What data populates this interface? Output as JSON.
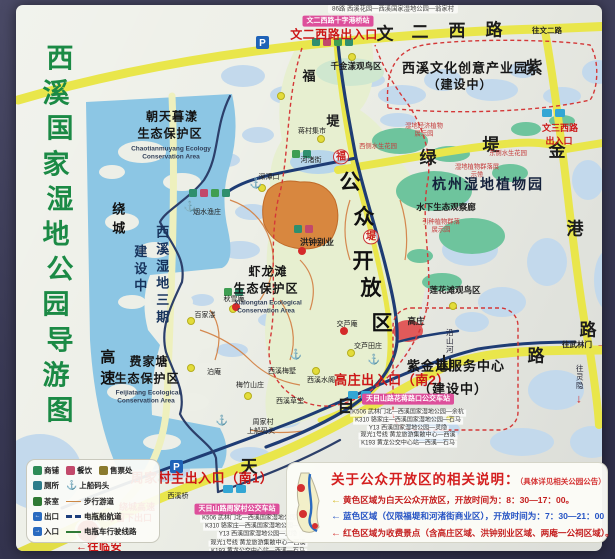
{
  "title": {
    "text": "西溪国家湿地公园导游图",
    "color": "#1b8a45"
  },
  "colors": {
    "road_yellow": "#e9e64b",
    "water_light": "#c3d9ec",
    "water_deep": "#8cc6e4",
    "open_area_green": "#e7efd0",
    "garden_teal": "#6ec49d",
    "canal_navy": "#1e3c74",
    "boundary_red_dash": "#d43838",
    "paid_area_orange": "#d8873f",
    "badge_pink": "#dd4f9b",
    "entrance_red": "#cc1616",
    "title_green": "#1b8a45"
  },
  "bus_lines": [
    "K506 武林门北—西溪国家湿地公园—余杭",
    "K310 骆家庄—西溪国家湿地公园—石马",
    "Y13 西溪国家湿地公园—灵隐",
    "观光1号线 黄龙旅游集散中心—西溪",
    "K193 黄龙公交中心站—西溪—石马"
  ],
  "bus_stations": [
    {
      "badge": "天目山路花蒋路口公交车站",
      "x": 408,
      "y": 399,
      "lx": 408,
      "y0": 413,
      "dy": 7.8
    },
    {
      "badge": "天目山路周家村公交车站",
      "x": 237,
      "y": 509,
      "lx": 258,
      "y0": 519,
      "dy": 8.2
    }
  ],
  "map_labels": [
    {
      "t": "86路 西溪花园—西溪国家湿地公园—翁家村",
      "x": 393,
      "y": 9,
      "c": "busTop"
    },
    {
      "t": "文二西路十字港桥站",
      "x": 338,
      "y": 21,
      "c": "badge"
    },
    {
      "t": "文二西路出入口",
      "x": 334,
      "y": 35,
      "c": "ent"
    },
    {
      "t": "文",
      "x": 385,
      "y": 34,
      "c": "rd"
    },
    {
      "t": "二",
      "x": 420,
      "y": 32,
      "c": "rd"
    },
    {
      "t": "西",
      "x": 457,
      "y": 31,
      "c": "rd"
    },
    {
      "t": "路",
      "x": 494,
      "y": 30,
      "c": "rd"
    },
    {
      "t": "往文二路",
      "x": 547,
      "y": 31,
      "c": "dir"
    },
    {
      "t": "千金漾观鸟区",
      "x": 356,
      "y": 67,
      "c": "poi"
    },
    {
      "t": "西溪文化创意产业园",
      "x": 465,
      "y": 69,
      "c": "area",
      "fs": 13
    },
    {
      "t": "（建设中）",
      "x": 460,
      "y": 85,
      "c": "area",
      "fs": 12
    },
    {
      "t": "紫",
      "x": 534,
      "y": 68,
      "c": "rd"
    },
    {
      "t": "金",
      "x": 557,
      "y": 151,
      "c": "rd"
    },
    {
      "t": "港",
      "x": 575,
      "y": 229,
      "c": "rd"
    },
    {
      "t": "路",
      "x": 588,
      "y": 330,
      "c": "rd"
    },
    {
      "t": "福",
      "x": 309,
      "y": 77,
      "c": "rd2"
    },
    {
      "t": "堤",
      "x": 333,
      "y": 122,
      "c": "rd2"
    },
    {
      "t": "蒋村集市",
      "x": 312,
      "y": 132,
      "c": "poiT"
    },
    {
      "t": "朝天暮漾",
      "x": 172,
      "y": 117,
      "c": "area"
    },
    {
      "t": "生态保护区",
      "x": 170,
      "y": 134,
      "c": "area"
    },
    {
      "t": "Chaotianmuyang Ecology",
      "x": 171,
      "y": 149,
      "c": "areaE"
    },
    {
      "t": "Conservation Area",
      "x": 171,
      "y": 157,
      "c": "areaE"
    },
    {
      "t": "湿地经济植物展示园",
      "x": 424,
      "y": 130,
      "c": "redT",
      "w": 40
    },
    {
      "t": "文三西路",
      "x": 560,
      "y": 128,
      "c": "entS"
    },
    {
      "t": "出入口",
      "x": 559,
      "y": 141,
      "c": "entS"
    },
    {
      "t": "绿",
      "x": 428,
      "y": 158,
      "c": "rd"
    },
    {
      "t": "堤",
      "x": 491,
      "y": 145,
      "c": "rd"
    },
    {
      "t": "西侧水生花园",
      "x": 378,
      "y": 147,
      "c": "redT"
    },
    {
      "t": "东侧水生花园",
      "x": 508,
      "y": 154,
      "c": "redT"
    },
    {
      "t": "湿地植物群落展示带",
      "x": 477,
      "y": 171,
      "c": "redT",
      "w": 48
    },
    {
      "t": "杭州湿地植物园",
      "x": 488,
      "y": 185,
      "c": "garden"
    },
    {
      "t": "水下生态观察廊",
      "x": 446,
      "y": 208,
      "c": "poi"
    },
    {
      "t": "引种植物群落展示园",
      "x": 441,
      "y": 226,
      "c": "redT",
      "w": 42
    },
    {
      "t": "河渚街",
      "x": 311,
      "y": 161,
      "c": "poiT"
    },
    {
      "t": "深潭口",
      "x": 269,
      "y": 178,
      "c": "poiT"
    },
    {
      "t": "烟水渔庄",
      "x": 207,
      "y": 213,
      "c": "poiT"
    },
    {
      "t": "洪钟别业",
      "x": 317,
      "y": 243,
      "c": "poi"
    },
    {
      "t": "公",
      "x": 350,
      "y": 183,
      "c": "big"
    },
    {
      "t": "众",
      "x": 364,
      "y": 218,
      "c": "big"
    },
    {
      "t": "开",
      "x": 363,
      "y": 262,
      "c": "big"
    },
    {
      "t": "放",
      "x": 371,
      "y": 289,
      "c": "big"
    },
    {
      "t": "区",
      "x": 382,
      "y": 324,
      "c": "big"
    },
    {
      "t": "福",
      "x": 341,
      "y": 157,
      "c": "circ"
    },
    {
      "t": "堤",
      "x": 371,
      "y": 237,
      "c": "circ"
    },
    {
      "t": "西溪湿地三期",
      "x": 161,
      "y": 276,
      "c": "vt"
    },
    {
      "t": "建设中",
      "x": 139,
      "y": 270,
      "c": "vt"
    },
    {
      "t": "绕城",
      "x": 117,
      "y": 221,
      "c": "vtB",
      "fs": 13
    },
    {
      "t": "高速",
      "x": 106,
      "y": 370,
      "c": "vtB"
    },
    {
      "t": "虾龙滩",
      "x": 268,
      "y": 272,
      "c": "area"
    },
    {
      "t": "生态保护区",
      "x": 266,
      "y": 289,
      "c": "area"
    },
    {
      "t": "Xialongtan Ecological",
      "x": 268,
      "y": 303,
      "c": "areaE"
    },
    {
      "t": "Conservation Area",
      "x": 266,
      "y": 311,
      "c": "areaE"
    },
    {
      "t": "秋雪庵",
      "x": 234,
      "y": 300,
      "c": "poiT"
    },
    {
      "t": "百家溇",
      "x": 205,
      "y": 316,
      "c": "poiT"
    },
    {
      "t": "费家塘",
      "x": 149,
      "y": 362,
      "c": "area"
    },
    {
      "t": "生态保护区",
      "x": 147,
      "y": 379,
      "c": "area"
    },
    {
      "t": "Feijiatang Ecological",
      "x": 148,
      "y": 393,
      "c": "areaE"
    },
    {
      "t": "Conservation Area",
      "x": 146,
      "y": 401,
      "c": "areaE"
    },
    {
      "t": "泊庵",
      "x": 214,
      "y": 373,
      "c": "poiT"
    },
    {
      "t": "梅竹山庄",
      "x": 250,
      "y": 386,
      "c": "poiT"
    },
    {
      "t": "西溪梅墅",
      "x": 282,
      "y": 372,
      "c": "poiT"
    },
    {
      "t": "西溪草堂",
      "x": 290,
      "y": 402,
      "c": "poiT"
    },
    {
      "t": "周家村",
      "x": 263,
      "y": 423,
      "c": "poiT"
    },
    {
      "t": "上船码头",
      "x": 261,
      "y": 432,
      "c": "poiT"
    },
    {
      "t": "交芦庵",
      "x": 347,
      "y": 325,
      "c": "poiT"
    },
    {
      "t": "交芦田庄",
      "x": 368,
      "y": 347,
      "c": "poiT"
    },
    {
      "t": "高庄",
      "x": 416,
      "y": 322,
      "c": "poi"
    },
    {
      "t": "西溪水阁",
      "x": 321,
      "y": 381,
      "c": "poiT"
    },
    {
      "t": "沿山河",
      "x": 449,
      "y": 341,
      "c": "vtT"
    },
    {
      "t": "天",
      "x": 249,
      "y": 467,
      "c": "rd"
    },
    {
      "t": "目",
      "x": 346,
      "y": 407,
      "c": "rd"
    },
    {
      "t": "山",
      "x": 444,
      "y": 364,
      "c": "rd"
    },
    {
      "t": "路",
      "x": 536,
      "y": 356,
      "c": "rd"
    },
    {
      "t": "高庄出入口（南2）",
      "x": 392,
      "y": 381,
      "c": "ent",
      "fs": 13
    },
    {
      "t": "莲花滩观鸟区",
      "x": 455,
      "y": 291,
      "c": "poi"
    },
    {
      "t": "紫金港服务中心",
      "x": 456,
      "y": 367,
      "c": "area",
      "fs": 13
    },
    {
      "t": "（建设中）",
      "x": 453,
      "y": 390,
      "c": "area",
      "fs": 13
    },
    {
      "t": "周家村主出入口（南1）",
      "x": 202,
      "y": 479,
      "c": "ent",
      "fs": 13
    },
    {
      "t": "西溪桥",
      "x": 178,
      "y": 497,
      "c": "poiT"
    },
    {
      "t": "往武林门",
      "x": 577,
      "y": 345,
      "c": "dir"
    },
    {
      "t": "→",
      "x": 602,
      "y": 344,
      "c": "redArrow"
    },
    {
      "t": "往灵隐",
      "x": 579,
      "y": 377,
      "c": "vtT"
    },
    {
      "t": "↓",
      "x": 579,
      "y": 399,
      "c": "redArrow"
    },
    {
      "t": "绕城高速",
      "x": 137,
      "y": 507,
      "c": "entS"
    },
    {
      "t": "留下出口",
      "x": 134,
      "y": 518,
      "c": "entS"
    },
    {
      "t": "↗",
      "x": 114,
      "y": 519,
      "c": "redArrow"
    },
    {
      "t": "←往临安",
      "x": 99,
      "y": 547,
      "c": "ent",
      "fs": 11
    },
    {
      "t": "⚓",
      "x": 190,
      "y": 207,
      "c": "anch"
    },
    {
      "t": "⚓",
      "x": 256,
      "y": 184,
      "c": "anch"
    },
    {
      "t": "⚓",
      "x": 222,
      "y": 421,
      "c": "anch"
    },
    {
      "t": "⚓",
      "x": 296,
      "y": 355,
      "c": "anch"
    },
    {
      "t": "⚓",
      "x": 374,
      "y": 360,
      "c": "anch"
    }
  ],
  "legend": {
    "rows": [
      [
        {
          "i": "shop",
          "l": "商铺"
        },
        {
          "i": "food",
          "l": "餐饮"
        },
        {
          "i": "ticket",
          "l": "售票处"
        }
      ],
      [
        {
          "i": "toilet",
          "l": "厕所"
        },
        {
          "i": "anchor",
          "l": "上船码头"
        }
      ],
      [
        {
          "i": "tea",
          "l": "茶室"
        },
        {
          "s": "path",
          "l": "步行游道"
        }
      ],
      [
        {
          "i": "exit",
          "l": "出口"
        },
        {
          "s": "boat",
          "l": "电瓶船航道"
        }
      ],
      [
        {
          "i": "enter",
          "l": "入口"
        },
        {
          "s": "cart",
          "l": "电瓶车行驶线路"
        }
      ]
    ]
  },
  "notice": {
    "title": "关于公众开放区的相关说明：",
    "suffix": "（具体详见相关公园公告）",
    "lines": [
      {
        "arrow": "←",
        "arrow_color": "#d4b820",
        "color": "#c41e1e",
        "text": "黄色区域为白天公众开放区，开放时间为：8：30—17：00。"
      },
      {
        "arrow": "←",
        "arrow_color": "#2553c4",
        "color": "#2553c4",
        "text": "蓝色区域（仅限福堤和河渚街商业区），开放时间为：7：30—21：00"
      },
      {
        "arrow": "←",
        "arrow_color": "#d43030",
        "color": "#c41e1e",
        "text": "红色区域为收费景点（含高庄区域、洪钟别业区域、两庵一公祠区域）。"
      }
    ]
  }
}
